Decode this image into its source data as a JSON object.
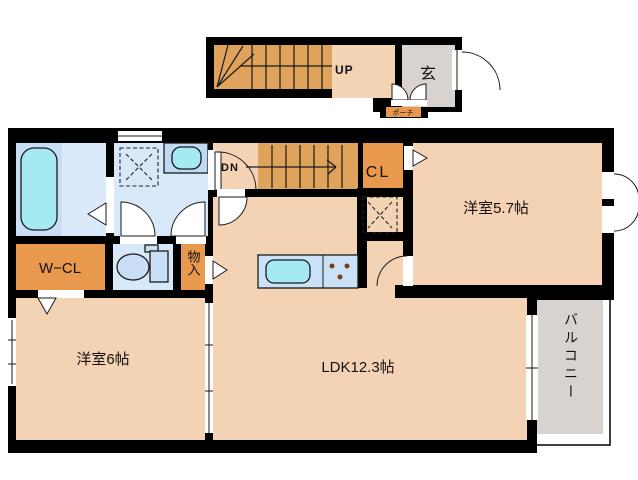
{
  "palette": {
    "wall": "#000000",
    "room": "#F4D3B4",
    "stairs": "#DFA35B",
    "closet": "#E9994E",
    "gray": "#D8D3CE",
    "bath": "#C7DEF4",
    "bath_floor": "#DBEAFA",
    "wash": "#D7E8F9",
    "cyan": "#A5E9F2",
    "counter": "#C9E2F7",
    "fixture": "#C9DFF5",
    "vanity": "#BFD9F2",
    "burner": "#7A3E10"
  },
  "floor1": {
    "up": "UP",
    "entrance": "玄",
    "porch": "ポーチ"
  },
  "floor2": {
    "dn": "DN",
    "closet": "CL",
    "walk_in_closet": "W−CL",
    "storage": "物入",
    "bedroom_small": "洋室5.7帖",
    "bedroom_large": "洋室6帖",
    "living": "LDK12.3帖",
    "balcony": "バルコニー"
  }
}
